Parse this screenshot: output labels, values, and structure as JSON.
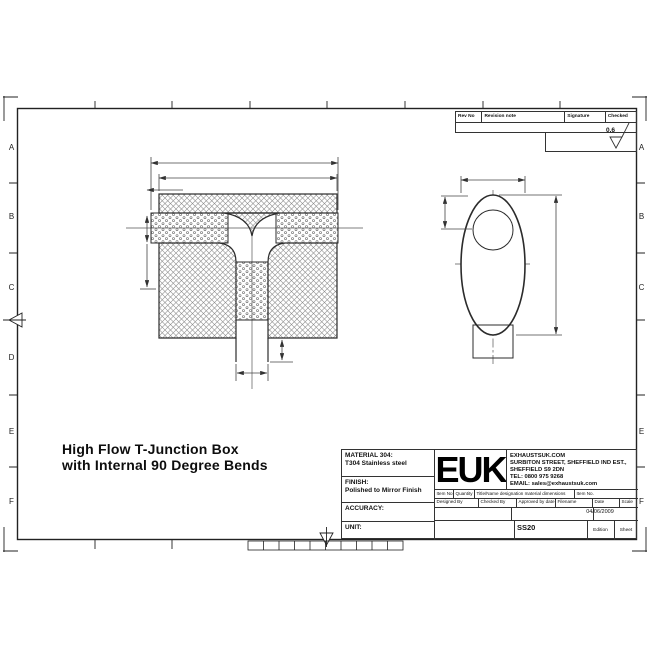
{
  "sheet": {
    "zone_labels_left": [
      "A",
      "B",
      "C",
      "D",
      "E",
      "F"
    ],
    "zone_labels_right": [
      "A",
      "B",
      "C",
      "E",
      "F"
    ]
  },
  "revision_table": {
    "col_rev_no": "Rev No",
    "col_revision_note": "Revision note",
    "col_signature": "Signature",
    "col_checked": "Checked",
    "surface_finish_value": "0.6"
  },
  "drawing_title": {
    "line1": "High Flow T-Junction Box",
    "line2": "with Internal 90 Degree Bends"
  },
  "title_block": {
    "material_label": "MATERIAL 304:",
    "material_value": "T304 Stainless steel",
    "finish_label": "FINISH:",
    "finish_value": "Polished to Mirror Finish",
    "accuracy_label": "ACCURACY:",
    "unit_label": "UNIT:",
    "logo_text": "EUK",
    "company_lines": [
      "EXHAUSTSUK.COM",
      "SURBITON STREET, SHEFFIELD IND EST.,",
      "SHEFFIELD S9 2DN",
      "TEL: 0800 975 9268",
      "EMAIL: sales@exhaustsuk.com"
    ],
    "parts_header": {
      "item_no": "Item No",
      "quantity": "Quantity",
      "title_name": "Title/Name designation material dimensions",
      "item_no2": "Item No."
    },
    "approval_header": {
      "designed_by": "Designed By",
      "checked_by": "Checked By",
      "approved_by": "Approved by date",
      "filename": "Filename",
      "date": "Date",
      "scale": "Scale"
    },
    "date_value": "04/06/2009",
    "drawing_number": "SS20",
    "edition_label": "Edition",
    "sheet_label": "Sheet"
  },
  "colors": {
    "line": "#2b2b2b",
    "dim_line": "#444444",
    "background": "#ffffff"
  }
}
